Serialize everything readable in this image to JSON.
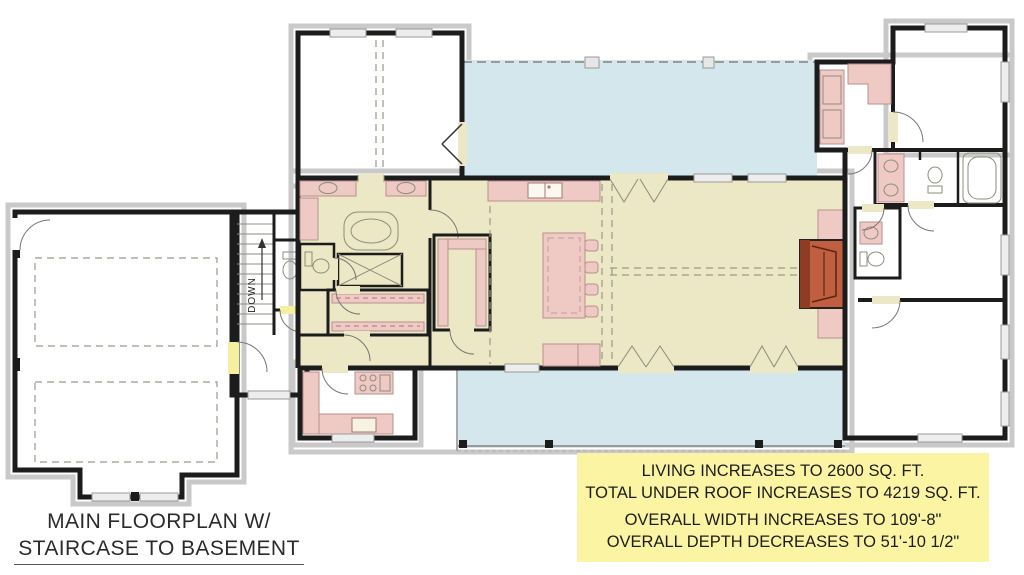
{
  "caption": {
    "line1": "MAIN FLOORPLAN W/",
    "line2": "STAIRCASE TO BASEMENT"
  },
  "info_box": {
    "background": "#FAF4A3",
    "lines": [
      "LIVING INCREASES TO 2600 SQ. FT.",
      "TOTAL UNDER ROOF INCREASES TO 4219 SQ. FT.",
      "OVERALL WIDTH INCREASES TO 109'-8\"",
      "OVERALL DEPTH DECREASES TO 51'-10 1/2\""
    ]
  },
  "plan": {
    "stair_label": "DOWN",
    "colors": {
      "floor": "#ECE7C4",
      "porch": "#D3E7ED",
      "stair_highlight": "#F5F0A0",
      "fixture_pink": "#EFC9C4",
      "fireplace": "#BF5F3F",
      "wall": "#1C1C1C",
      "roof_edge": "#C9C9C9"
    }
  }
}
